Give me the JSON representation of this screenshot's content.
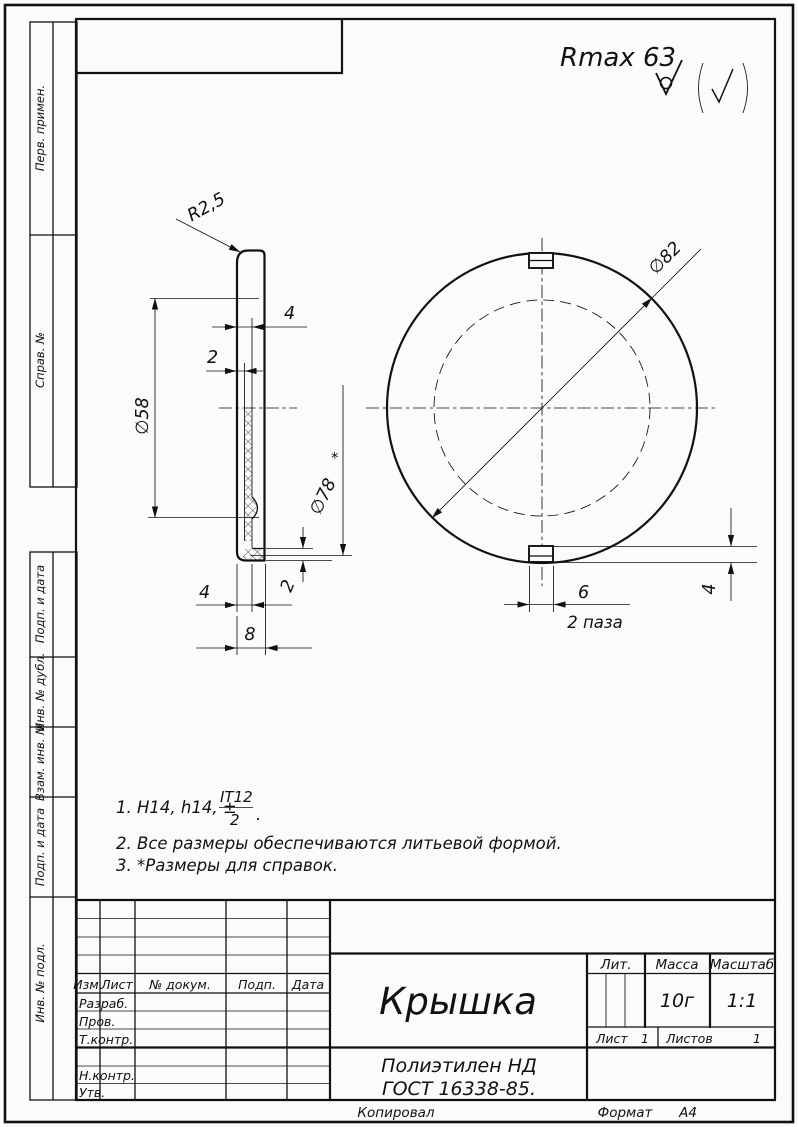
{
  "roughness": {
    "value": "Rmax 63"
  },
  "margin": {
    "labels": [
      "Перв. примен.",
      "Справ. №",
      "Подп. и дата",
      "Инв. № дубл.",
      "Взам. инв. №",
      "Подп. и дата",
      "Инв. № подл."
    ]
  },
  "section_view": {
    "dims": {
      "corner_radius": "R2,5",
      "rim_width": "4",
      "rim_step": "2",
      "bead_diameter": "∅58",
      "lip_inner_diameter": "∅78",
      "reference_mark": "*",
      "lip_thickness": "2",
      "foot_width": "4",
      "total_height": "8"
    }
  },
  "top_view": {
    "dims": {
      "outer_diameter": "∅82",
      "slot_width": "6",
      "slot_count_note": "2 паза",
      "slot_depth": "4"
    }
  },
  "notes": {
    "items": [
      {
        "num": "1.",
        "text": "H14, h14, ±",
        "frac_num": "IT12",
        "frac_den": "2",
        "tail": "."
      },
      {
        "num": "2.",
        "text": "Все размеры обеспечиваются литьевой формой."
      },
      {
        "num": "3.",
        "text": "*Размеры для справок."
      }
    ]
  },
  "title_block": {
    "columns": {
      "izm": "Изм.",
      "list": "Лист",
      "doc": "№ докум.",
      "podp": "Подп.",
      "data": "Дата"
    },
    "rows": {
      "razrab": "Разраб.",
      "prov": "Пров.",
      "tkontr": "Т.контр.",
      "nkontr": "Н.контр.",
      "utv": "Утв."
    },
    "part_name": "Крышка",
    "lit_label": "Лит.",
    "mass_label": "Масса",
    "scale_label": "Масштаб",
    "mass_value": "10г",
    "scale_value": "1:1",
    "sheet_label": "Лист",
    "sheet_value": "1",
    "sheets_label": "Листов",
    "sheets_value": "1",
    "material_line1": "Полиэтилен НД",
    "material_line2": "ГОСТ 16338-85."
  },
  "footer": {
    "copied": "Копировал",
    "format_label": "Формат",
    "format_value": "А4"
  }
}
